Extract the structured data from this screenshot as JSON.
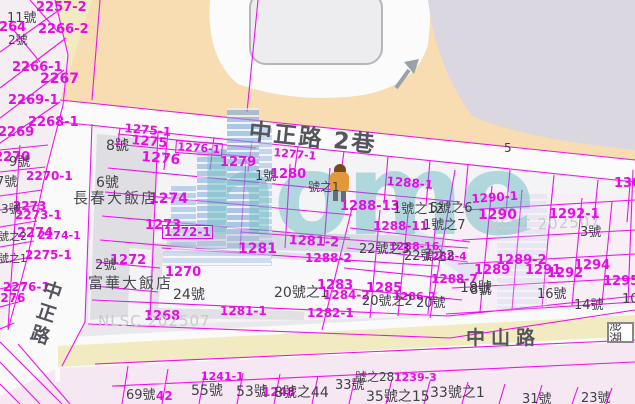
{
  "map": {
    "roads": {
      "lane_label": "中正路 2巷",
      "vertical_road_label": "中正路",
      "bottom_road_label": "中山路",
      "lane_lot_number": "5"
    },
    "buildings": {
      "hotel_1": "長春大飯店",
      "hotel_2": "富華大飯店"
    },
    "admin_box": "澎湖",
    "watermark": {
      "logo_text": "home",
      "credit": "NLSC 202507"
    },
    "colors": {
      "parcel_line_magenta": "#e60ce6",
      "block_peach": "#f8dcb2",
      "block_lavender": "#dad7e1",
      "road_yellow": "#f2ebc2",
      "logo_teal": "#2ea6ab",
      "logo_blue": "#7fa9dc"
    }
  },
  "labels": [
    {
      "t": "2257-2",
      "x": 36,
      "y": 1,
      "k": "p",
      "fs": 13
    },
    {
      "t": "11號",
      "x": 7,
      "y": 12,
      "k": "h",
      "fs": 13
    },
    {
      "t": "2264",
      "x": -10,
      "y": 21,
      "k": "p",
      "fs": 13
    },
    {
      "t": "2266-2",
      "x": 38,
      "y": 23,
      "k": "p",
      "fs": 13
    },
    {
      "t": "2號",
      "x": 8,
      "y": 34,
      "k": "h",
      "fs": 12
    },
    {
      "t": "2266-1",
      "x": 12,
      "y": 61,
      "k": "p",
      "fs": 13
    },
    {
      "t": "2267",
      "x": 40,
      "y": 72,
      "k": "p",
      "fs": 14
    },
    {
      "t": "2269-1",
      "x": 8,
      "y": 94,
      "k": "p",
      "fs": 13
    },
    {
      "t": "2268-1",
      "x": 28,
      "y": 116,
      "k": "p",
      "fs": 13
    },
    {
      "t": "2269",
      "x": -2,
      "y": 126,
      "k": "p",
      "fs": 13
    },
    {
      "t": "2270",
      "x": -6,
      "y": 151,
      "k": "p",
      "fs": 13
    },
    {
      "t": "9號",
      "x": 9,
      "y": 156,
      "k": "h",
      "fs": 13
    },
    {
      "t": "2270-1",
      "x": 26,
      "y": 170,
      "k": "p",
      "fs": 12
    },
    {
      "t": "7號",
      "x": -4,
      "y": 176,
      "k": "h",
      "fs": 13
    },
    {
      "t": "2273",
      "x": 13,
      "y": 200,
      "k": "p",
      "fs": 12
    },
    {
      "t": "3號",
      "x": 1,
      "y": 203,
      "k": "h",
      "fs": 12
    },
    {
      "t": "2273-1",
      "x": 15,
      "y": 209,
      "k": "p",
      "fs": 12
    },
    {
      "t": "2274",
      "x": 17,
      "y": 227,
      "k": "p",
      "fs": 13
    },
    {
      "t": "號之2",
      "x": -2,
      "y": 231,
      "k": "h",
      "fs": 11
    },
    {
      "t": "2274-1",
      "x": 38,
      "y": 230,
      "k": "p",
      "fs": 11
    },
    {
      "t": "2275-1",
      "x": 25,
      "y": 249,
      "k": "p",
      "fs": 12
    },
    {
      "t": "號之1",
      "x": -2,
      "y": 253,
      "k": "h",
      "fs": 11
    },
    {
      "t": "2276-1",
      "x": 3,
      "y": 281,
      "k": "p",
      "fs": 12
    },
    {
      "t": "2276",
      "x": -8,
      "y": 292,
      "k": "p",
      "fs": 12
    },
    {
      "t": "1275-1",
      "x": 125,
      "y": 122,
      "k": "p",
      "fs": 12,
      "rot": 5
    },
    {
      "t": "1275",
      "x": 132,
      "y": 134,
      "k": "p",
      "fs": 13,
      "rot": 5
    },
    {
      "t": "8號",
      "x": 106,
      "y": 139,
      "k": "h",
      "fs": 14
    },
    {
      "t": "1276-1",
      "x": 176,
      "y": 140,
      "k": "p",
      "fs": 11,
      "box": true,
      "rot": 4
    },
    {
      "t": "1276",
      "x": 142,
      "y": 150,
      "k": "p",
      "fs": 14,
      "rot": 5
    },
    {
      "t": "1279",
      "x": 220,
      "y": 156,
      "k": "p",
      "fs": 13
    },
    {
      "t": "1277-1",
      "x": 274,
      "y": 147,
      "k": "p",
      "fs": 11,
      "rot": 5
    },
    {
      "t": "1號",
      "x": 255,
      "y": 170,
      "k": "h",
      "fs": 13
    },
    {
      "t": "1280",
      "x": 270,
      "y": 168,
      "k": "p",
      "fs": 13
    },
    {
      "t": "5",
      "x": 504,
      "y": 142,
      "k": "h",
      "fs": 12
    },
    {
      "t": "號之1",
      "x": 308,
      "y": 181,
      "k": "h",
      "fs": 12
    },
    {
      "t": "1288-1",
      "x": 387,
      "y": 175,
      "k": "p",
      "fs": 12,
      "rot": 5
    },
    {
      "t": "1288-13",
      "x": 340,
      "y": 200,
      "k": "p",
      "fs": 13
    },
    {
      "t": "1號之12",
      "x": 393,
      "y": 203,
      "k": "h",
      "fs": 13
    },
    {
      "t": "5號之6",
      "x": 430,
      "y": 202,
      "k": "h",
      "fs": 13
    },
    {
      "t": "1288-11",
      "x": 373,
      "y": 220,
      "k": "p",
      "fs": 12
    },
    {
      "t": "1號之7",
      "x": 423,
      "y": 219,
      "k": "h",
      "fs": 13
    },
    {
      "t": "1290-1",
      "x": 471,
      "y": 193,
      "k": "p",
      "fs": 12,
      "rot": -4
    },
    {
      "t": "1290",
      "x": 478,
      "y": 208,
      "k": "p",
      "fs": 14
    },
    {
      "t": "NLSC 202507",
      "x": 488,
      "y": 220,
      "k": "w",
      "fs": 15,
      "rot": -3
    },
    {
      "t": "1292-1",
      "x": 549,
      "y": 208,
      "k": "p",
      "fs": 13
    },
    {
      "t": "1301",
      "x": 614,
      "y": 177,
      "k": "p",
      "fs": 13
    },
    {
      "t": "3號",
      "x": 580,
      "y": 226,
      "k": "h",
      "fs": 13
    },
    {
      "t": "1272-1",
      "x": 162,
      "y": 225,
      "k": "p",
      "fs": 12,
      "box": true
    },
    {
      "t": "1273",
      "x": 145,
      "y": 219,
      "k": "p",
      "fs": 13
    },
    {
      "t": "1274",
      "x": 149,
      "y": 192,
      "k": "p",
      "fs": 14
    },
    {
      "t": "6號",
      "x": 96,
      "y": 176,
      "k": "h",
      "fs": 14
    },
    {
      "t": "長春大飯店",
      "x": 73,
      "y": 191,
      "k": "hl",
      "fs": 15
    },
    {
      "t": "1272",
      "x": 110,
      "y": 254,
      "k": "p",
      "fs": 13
    },
    {
      "t": "2號",
      "x": 95,
      "y": 259,
      "k": "h",
      "fs": 13
    },
    {
      "t": "富華大飯店",
      "x": 88,
      "y": 276,
      "k": "hl",
      "fs": 15
    },
    {
      "t": "1270",
      "x": 165,
      "y": 266,
      "k": "p",
      "fs": 13
    },
    {
      "t": "1268",
      "x": 144,
      "y": 310,
      "k": "p",
      "fs": 13
    },
    {
      "t": "24號",
      "x": 173,
      "y": 288,
      "k": "h",
      "fs": 14
    },
    {
      "t": "1281",
      "x": 238,
      "y": 242,
      "k": "p",
      "fs": 14
    },
    {
      "t": "1281-2",
      "x": 289,
      "y": 234,
      "k": "p",
      "fs": 13,
      "rot": 3
    },
    {
      "t": "1281-1",
      "x": 220,
      "y": 305,
      "k": "p",
      "fs": 12
    },
    {
      "t": "1282-1",
      "x": 307,
      "y": 307,
      "k": "p",
      "fs": 12
    },
    {
      "t": "20號之1",
      "x": 274,
      "y": 286,
      "k": "h",
      "fs": 14
    },
    {
      "t": "1283",
      "x": 317,
      "y": 279,
      "k": "p",
      "fs": 13
    },
    {
      "t": "1284-2",
      "x": 323,
      "y": 289,
      "k": "p",
      "fs": 12
    },
    {
      "t": "1288-2",
      "x": 305,
      "y": 252,
      "k": "p",
      "fs": 12
    },
    {
      "t": "1288-16",
      "x": 389,
      "y": 241,
      "k": "p",
      "fs": 11
    },
    {
      "t": "22號之3",
      "x": 359,
      "y": 243,
      "k": "h",
      "fs": 13
    },
    {
      "t": "1288-4",
      "x": 424,
      "y": 251,
      "k": "p",
      "fs": 11
    },
    {
      "t": "22號之2",
      "x": 404,
      "y": 250,
      "k": "h",
      "fs": 13
    },
    {
      "t": "1288-7",
      "x": 431,
      "y": 273,
      "k": "p",
      "fs": 12
    },
    {
      "t": "18號",
      "x": 460,
      "y": 281,
      "k": "h",
      "fs": 14
    },
    {
      "t": "1285",
      "x": 366,
      "y": 282,
      "k": "p",
      "fs": 13
    },
    {
      "t": "1286-2",
      "x": 393,
      "y": 291,
      "k": "p",
      "fs": 11
    },
    {
      "t": "20號之2",
      "x": 362,
      "y": 295,
      "k": "h",
      "fs": 13
    },
    {
      "t": "20號",
      "x": 416,
      "y": 297,
      "k": "h",
      "fs": 13
    },
    {
      "t": "NLSC 202507",
      "x": 98,
      "y": 314,
      "k": "w",
      "fs": 15
    },
    {
      "t": "1289-2",
      "x": 496,
      "y": 254,
      "k": "p",
      "fs": 13
    },
    {
      "t": "1289",
      "x": 474,
      "y": 264,
      "k": "p",
      "fs": 13
    },
    {
      "t": "1291",
      "x": 525,
      "y": 264,
      "k": "p",
      "fs": 13
    },
    {
      "t": "1292",
      "x": 547,
      "y": 267,
      "k": "p",
      "fs": 13
    },
    {
      "t": "1294",
      "x": 574,
      "y": 259,
      "k": "p",
      "fs": 13
    },
    {
      "t": "1295",
      "x": 603,
      "y": 275,
      "k": "p",
      "fs": 13
    },
    {
      "t": "8號",
      "x": 470,
      "y": 284,
      "k": "h",
      "fs": 13
    },
    {
      "t": "16號",
      "x": 537,
      "y": 288,
      "k": "h",
      "fs": 13
    },
    {
      "t": "14號",
      "x": 574,
      "y": 299,
      "k": "h",
      "fs": 13
    },
    {
      "t": "10號",
      "x": 622,
      "y": 293,
      "k": "h",
      "fs": 13
    },
    {
      "t": "1241-1",
      "x": 201,
      "y": 371,
      "k": "p",
      "fs": 11
    },
    {
      "t": "1239-3",
      "x": 394,
      "y": 372,
      "k": "p",
      "fs": 11
    },
    {
      "t": "號之28",
      "x": 355,
      "y": 371,
      "k": "h",
      "fs": 12
    },
    {
      "t": "55號",
      "x": 191,
      "y": 384,
      "k": "h",
      "fs": 14
    },
    {
      "t": "53號",
      "x": 236,
      "y": 385,
      "k": "h",
      "fs": 14
    },
    {
      "t": "1248",
      "x": 262,
      "y": 386,
      "k": "p",
      "fs": 12
    },
    {
      "t": "8號之44",
      "x": 274,
      "y": 386,
      "k": "h",
      "fs": 14
    },
    {
      "t": "33號",
      "x": 335,
      "y": 379,
      "k": "h",
      "fs": 13
    },
    {
      "t": "35號之15",
      "x": 366,
      "y": 390,
      "k": "h",
      "fs": 14
    },
    {
      "t": "33號之1",
      "x": 430,
      "y": 386,
      "k": "h",
      "fs": 14
    },
    {
      "t": "31號",
      "x": 522,
      "y": 393,
      "k": "h",
      "fs": 13
    },
    {
      "t": "23號",
      "x": 581,
      "y": 392,
      "k": "h",
      "fs": 13
    },
    {
      "t": "69號",
      "x": 126,
      "y": 389,
      "k": "h",
      "fs": 13
    },
    {
      "t": "42",
      "x": 156,
      "y": 390,
      "k": "p",
      "fs": 12
    },
    {
      "t": "中正路 2巷",
      "x": 250,
      "y": 121,
      "k": "r",
      "fs": 23,
      "rot": 6,
      "ls": 2
    },
    {
      "t": "中山路",
      "x": 466,
      "y": 329,
      "k": "r",
      "fs": 19,
      "ls": 6
    },
    {
      "t": "中",
      "x": 46,
      "y": 280,
      "k": "r",
      "fs": 19,
      "rot": 18
    },
    {
      "t": "正",
      "x": 40,
      "y": 302,
      "k": "r",
      "fs": 19,
      "rot": 18
    },
    {
      "t": "路",
      "x": 34,
      "y": 324,
      "k": "r",
      "fs": 19,
      "rot": 18
    }
  ]
}
